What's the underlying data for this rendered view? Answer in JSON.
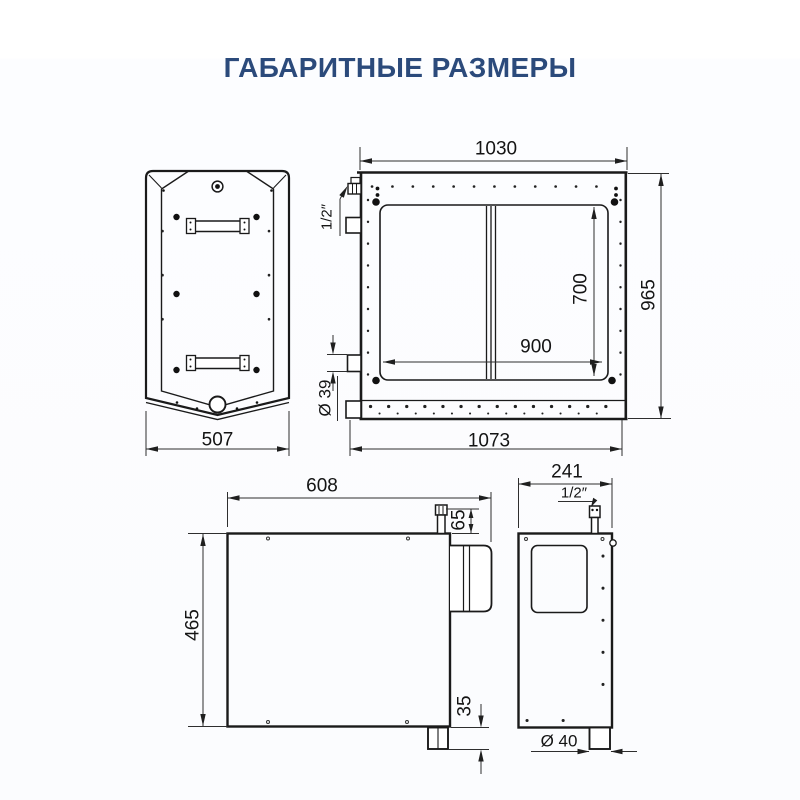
{
  "title": "ГАБАРИТНЫЕ РАЗМЕРЫ",
  "colors": {
    "title_text": "#2b4a7b",
    "drawing_lines": "#1a1a1a",
    "background": "#fdfdff"
  },
  "drawing": {
    "top_view": {
      "dimensions": {
        "width": "507"
      }
    },
    "front_view": {
      "dimensions": {
        "body_width": "1030",
        "body_height": "965",
        "door_height": "700",
        "door_width": "900",
        "overall_width": "1073",
        "fitting_thread": "1/2″",
        "pipe_diameter": "Ø 39"
      }
    },
    "side_view": {
      "dimensions": {
        "depth": "608",
        "height": "465",
        "fitting_height": "65",
        "drain_stub": "35"
      }
    },
    "back_view": {
      "dimensions": {
        "depth": "241",
        "fitting_thread": "1/2″",
        "drain_diameter": "Ø 40"
      }
    }
  }
}
